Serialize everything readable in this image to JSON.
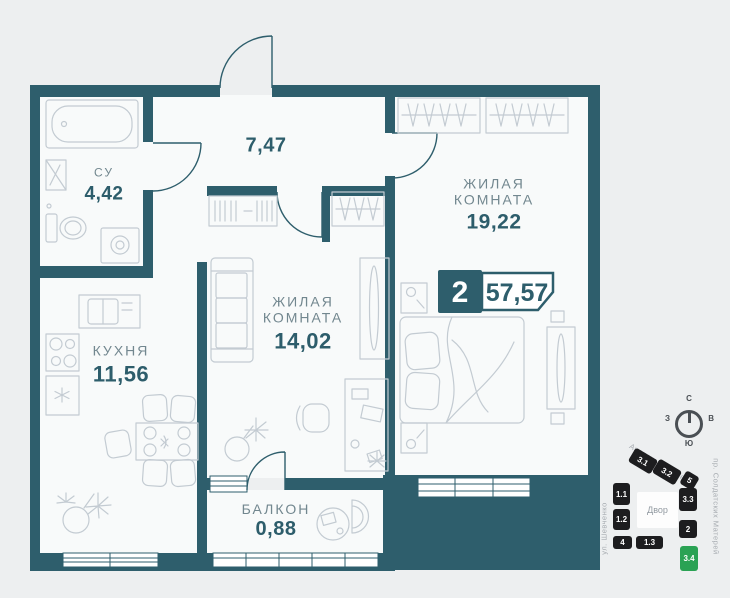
{
  "floorplan": {
    "rooms": [
      {
        "name": "СУ",
        "area": "4,42"
      },
      {
        "name": "КУХНЯ",
        "area": "11,56"
      },
      {
        "name": "",
        "area": "7,47"
      },
      {
        "name": "ЖИЛАЯ КОМНАТА",
        "area": "14,02"
      },
      {
        "name": "ЖИЛАЯ КОМНАТА",
        "area": "19,22"
      },
      {
        "name": "БАЛКОН",
        "area": "0,88"
      }
    ],
    "badge": {
      "rooms_count": "2",
      "total_area": "57,57"
    }
  },
  "compass": {
    "north": "С",
    "south": "Ю",
    "west": "З",
    "east": "В"
  },
  "minimap": {
    "courtyard": "Двор",
    "streets": [
      {
        "name": "Анапское шоссе"
      },
      {
        "name": "ул. Шевченко"
      },
      {
        "name": "пр. Солдатских Матерей"
      }
    ],
    "buildings": [
      {
        "id": "3.1",
        "highlighted": false
      },
      {
        "id": "3.2",
        "highlighted": false
      },
      {
        "id": "5",
        "highlighted": false
      },
      {
        "id": "1.1",
        "highlighted": false
      },
      {
        "id": "1.2",
        "highlighted": false
      },
      {
        "id": "4",
        "highlighted": false
      },
      {
        "id": "1.3",
        "highlighted": false
      },
      {
        "id": "3.3",
        "highlighted": false
      },
      {
        "id": "2",
        "highlighted": false
      },
      {
        "id": "3.4",
        "highlighted": true
      }
    ]
  },
  "colors": {
    "wall": "#2e5e6c",
    "building_tile": "#1d1d1f",
    "highlight_green": "#2aa254"
  }
}
